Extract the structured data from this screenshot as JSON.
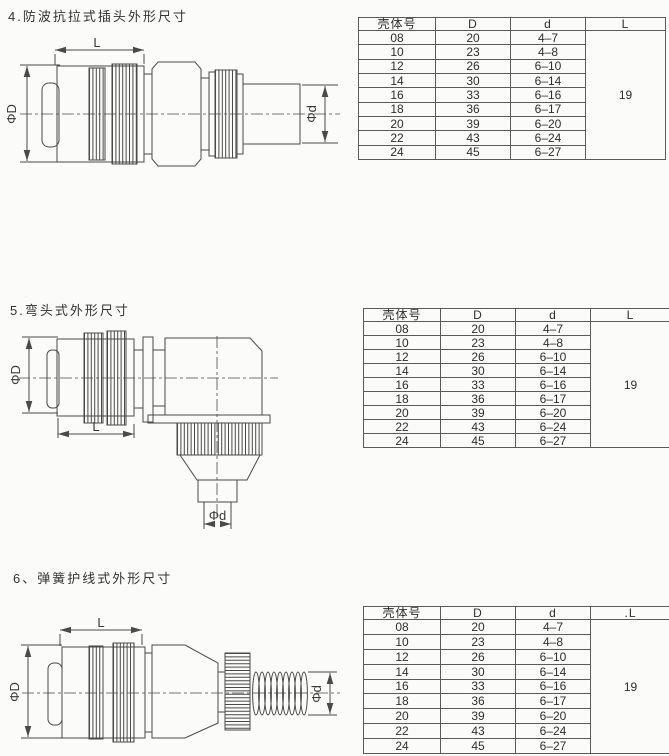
{
  "page": {
    "background": "#fbfbf9",
    "ink": "#2f2f2f",
    "line_color": "#4a4a4a"
  },
  "sections": [
    {
      "title": "4.防波抗拉式插头外形尺寸",
      "drawing": {
        "dim_length": "L",
        "dim_outer": "ΦD",
        "dim_inner": "Φd"
      },
      "table": {
        "headers": [
          "壳体号",
          "D",
          "d",
          "L"
        ],
        "rows": [
          [
            "08",
            "20",
            "4–7"
          ],
          [
            "10",
            "23",
            "4–8"
          ],
          [
            "12",
            "26",
            "6–10"
          ],
          [
            "14",
            "30",
            "6–14"
          ],
          [
            "16",
            "33",
            "6–16"
          ],
          [
            "18",
            "36",
            "6–17"
          ],
          [
            "20",
            "39",
            "6–20"
          ],
          [
            "22",
            "43",
            "6–24"
          ],
          [
            "24",
            "45",
            "6–27"
          ]
        ],
        "merged_value": "19"
      }
    },
    {
      "title": "5.弯头式外形尺寸",
      "drawing": {
        "dim_length": "L",
        "dim_outer": "ΦD",
        "dim_inner": "Φd"
      },
      "table": {
        "headers": [
          "壳体号",
          "D",
          "d",
          "L"
        ],
        "rows": [
          [
            "08",
            "20",
            "4–7"
          ],
          [
            "10",
            "23",
            "4–8"
          ],
          [
            "12",
            "26",
            "6–10"
          ],
          [
            "14",
            "30",
            "6–14"
          ],
          [
            "16",
            "33",
            "6–16"
          ],
          [
            "18",
            "36",
            "6–17"
          ],
          [
            "20",
            "39",
            "6–20"
          ],
          [
            "22",
            "43",
            "6–24"
          ],
          [
            "24",
            "45",
            "6–27"
          ]
        ],
        "merged_value": "19"
      }
    },
    {
      "title": "6、弹簧护线式外形尺寸",
      "drawing": {
        "dim_length": "L",
        "dim_outer": "ΦD",
        "dim_inner": "Φd"
      },
      "table": {
        "headers": [
          "壳体号",
          "D",
          "d",
          ".L"
        ],
        "rows": [
          [
            "08",
            "20",
            "4–7"
          ],
          [
            "10",
            "23",
            "4–8"
          ],
          [
            "12",
            "26",
            "6–10"
          ],
          [
            "14",
            "30",
            "6–14"
          ],
          [
            "16",
            "33",
            "6–16"
          ],
          [
            "18",
            "36",
            "6–17"
          ],
          [
            "20",
            "39",
            "6–20"
          ],
          [
            "22",
            "43",
            "6–24"
          ],
          [
            "24",
            "45",
            "6–27"
          ]
        ],
        "merged_value": "19"
      }
    }
  ]
}
